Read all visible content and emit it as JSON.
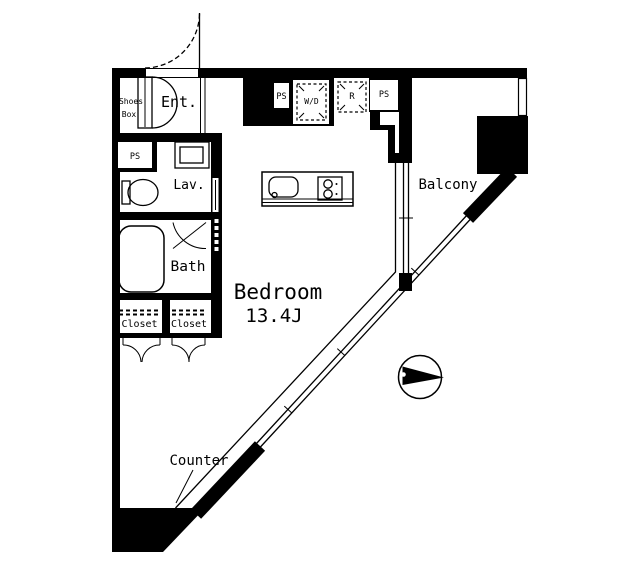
{
  "plan": {
    "title": "1R apartment floor plan",
    "colors": {
      "wall": "#000000",
      "background": "#ffffff"
    },
    "rooms": {
      "entrance": "Ent.",
      "shoes_box_line1": "Shoes",
      "shoes_box_line2": "Box",
      "lavatory": "Lav.",
      "bath": "Bath",
      "closet_left": "Closet",
      "closet_right": "Closet",
      "bedroom": "Bedroom",
      "bedroom_size": "13.4J",
      "balcony": "Balcony",
      "counter": "Counter"
    },
    "utilities": {
      "ps_top_left": "PS",
      "ps_top_right": "PS",
      "ps_side": "PS",
      "washer_dryer": "W/D",
      "refrigerator": "R"
    }
  }
}
